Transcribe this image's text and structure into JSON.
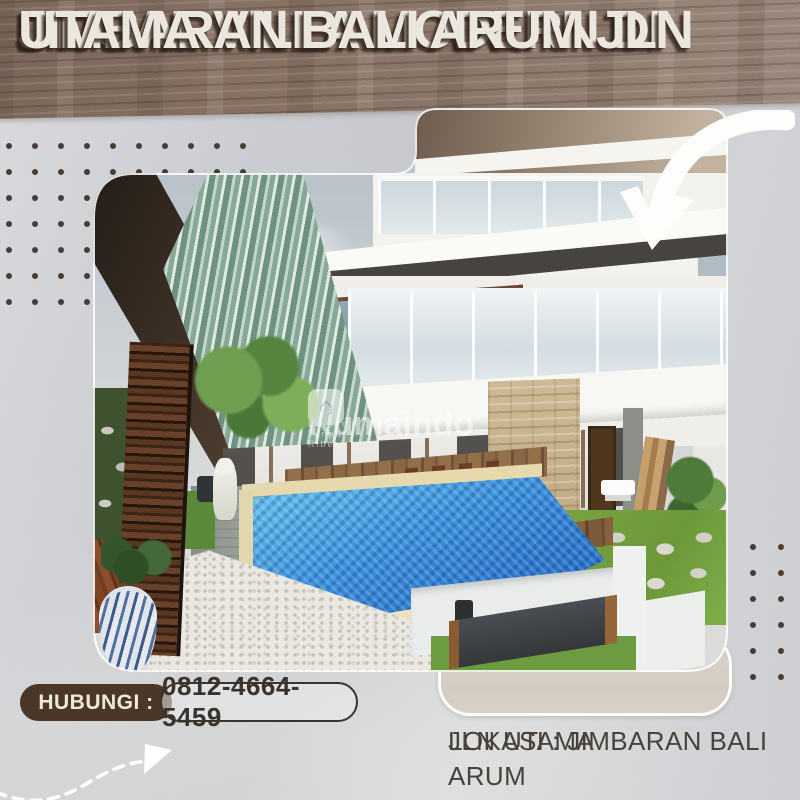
{
  "flyer": {
    "title_lines": [
      "DIJUAL VILLA MODERN DI",
      "JIMBARAN BALI ARUM JLN",
      "UTAMA"
    ],
    "contact": {
      "label": "HUBUNGI :",
      "phone": "0812-4664-5459"
    },
    "location": {
      "line1": "LOKASI : JIMBARAN BALI ARUM",
      "line2": "JLN UTAMA"
    },
    "watermark": {
      "brand": "Rumaindo",
      "tagline": "Cari Properti Tanpa Ribet",
      "logo_glyph": "⌂"
    },
    "icons": {
      "curved_arrow": "curved-arrow-down-left",
      "dashed_arrow": "dashed-wave-arrow-up-right",
      "dots": "decorative-dot-grid"
    },
    "colors": {
      "background": "#cbcdd1",
      "wood_banner": "#877264",
      "title_text": "#ece7de",
      "title_shadow": "#30221a",
      "contact_pill": "#4a3728",
      "contact_text": "#efe8dd",
      "phone_text": "#3a332c",
      "location_text": "#48423c",
      "pool_blue": "#2f7fd4",
      "dot_brown": "#4a3c33",
      "tab_greige": "#d5cfc6"
    }
  }
}
